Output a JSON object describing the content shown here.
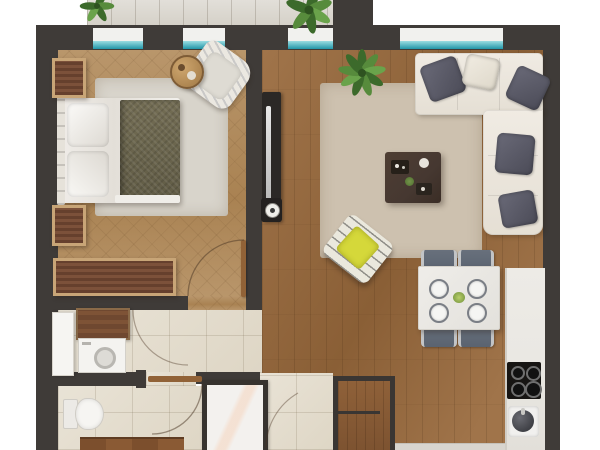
{
  "title": "Rendered 2D apartment floor plan (top-down view, no text labels)",
  "scene": {
    "type": "floor-plan",
    "rooms": [
      {
        "name": "bedroom",
        "furniture": [
          "double bed with white linens and dark olive duvet",
          "two nightstands",
          "long dresser",
          "striped armchair",
          "round side table",
          "light gray area rug"
        ]
      },
      {
        "name": "living-room",
        "furniture": [
          "L-shaped cream sectional sofa",
          "five throw pillows",
          "dark coffee table with decor",
          "beige area rug",
          "TV console with TV",
          "potted plant",
          "yellow lounge chair"
        ]
      },
      {
        "name": "dining-area",
        "furniture": [
          "square marble dining table",
          "four gray chairs",
          "four place settings",
          "green centerpiece"
        ]
      },
      {
        "name": "kitchen",
        "furniture": [
          "counter along right wall",
          "four-burner cooktop",
          "round sink"
        ]
      },
      {
        "name": "hallway",
        "furniture": [
          "closet shelf",
          "washing machine",
          "white door leaf"
        ]
      },
      {
        "name": "bathroom",
        "furniture": [
          "toilet",
          "walk-in shower",
          "wood vanity edge"
        ]
      },
      {
        "name": "entry",
        "furniture": [
          "tall wood cabinet",
          "front-door swing arc"
        ]
      },
      {
        "name": "balcony",
        "furniture": [
          "tiled floor",
          "two plants"
        ]
      }
    ],
    "window_count": 4,
    "door_swing_count": 4
  },
  "palette": {
    "wall": "#3f3b38",
    "glass_a": "#2196a8",
    "glass_b": "#9adde2",
    "sill": "#f1f1ee",
    "wood_bed_a": "#b9966b",
    "wood_bed_b": "#a98252",
    "wood_living_a": "#a0744a",
    "wood_living_b": "#8a5f36",
    "tile_a": "#e9e3d6",
    "tile_b": "#ded6c5",
    "balcony_a": "#e2dfd9",
    "balcony_b": "#d5d1c8",
    "rug_bed": "#d8d4cb",
    "rug_living": "#cdc1af",
    "sofa_a": "#f0ebe3",
    "sofa_b": "#e5dfd4",
    "pillow_a": "#6a6a78",
    "pillow_b": "#4b4b57",
    "pillow_light": "#ded8ca",
    "duvet_a": "#736d54",
    "duvet_b": "#615c46",
    "furn_frame": "#c8a577",
    "furn_wood_a": "#7c513a",
    "furn_wood_b": "#66402d",
    "table_dark": "#463831",
    "counter": "#eae8e3",
    "cooktop": "#171513",
    "chair": "#5a6370",
    "yellow": "#d5d83a",
    "plant_a": "#3c6a2b",
    "plant_b": "#578b3c",
    "plant_c": "#6aa34b",
    "shower_frame": "#37332f",
    "white_goods": "#f4f3f0",
    "door_wood": "#916237",
    "arc": "#4a3524"
  }
}
